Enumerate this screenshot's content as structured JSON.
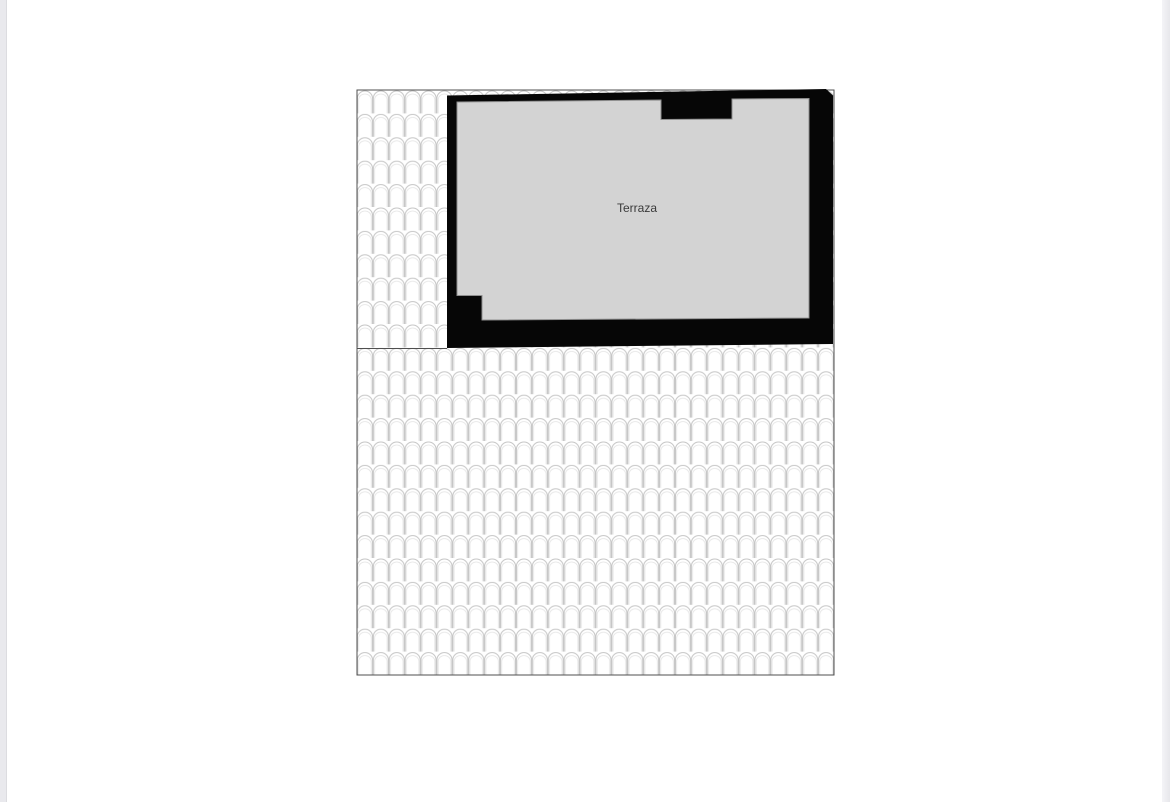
{
  "page": {
    "background_color": "#ffffff",
    "edge_strip_color": "#e9e9ed",
    "edge_strip_border_color": "#dcdce0"
  },
  "floorplan": {
    "label": "Terraza",
    "label_color": "#3a3a3a",
    "label_x": "637",
    "label_y": "212",
    "colors": {
      "wall": "#060606",
      "floor": "#d3d3d3",
      "floor_outline": "#8f8f8f",
      "tile_line": "#c6c6c6",
      "tile_line_faint": "#e4e4e4",
      "tile_background": "#ffffff",
      "region_border": "#4f4f4f"
    },
    "geometry": {
      "tile_region": {
        "x": "357",
        "y": "90",
        "width": "477",
        "height": "585"
      },
      "tile_cell": {
        "width": "15.9",
        "height": "23.4"
      },
      "tile_arch_path": "M0.45,23.4 L0.45,8.1 A7.5,7.1 0 0 1 15.45,8.1 L15.45,23.4",
      "tile_arch_inner_path": "M1.7,23.4 L1.7,9.2 A6.3,6.0 0 0 1 14.2,9.2 L14.2,23.4",
      "divider_x1": "357",
      "divider_y1": "348.5",
      "divider_x2": "447",
      "divider_y2": "348.5",
      "building_points": "447,95.5 826,89 833,95.5 833,344 447,348",
      "floor_points": "457,102 661,100 661,119.5 732,119 732,99 809,98.5 809,318 482,320 482,295.5 457,295.5"
    }
  }
}
